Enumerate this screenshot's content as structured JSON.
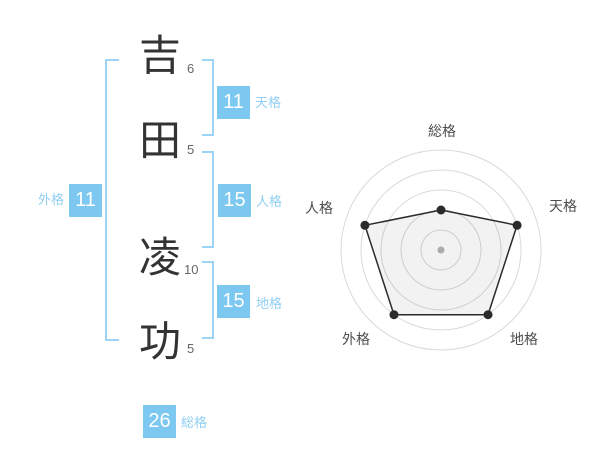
{
  "name_block": {
    "characters": [
      {
        "char": "吉",
        "strokes": "6"
      },
      {
        "char": "田",
        "strokes": "5"
      },
      {
        "char": "凌",
        "strokes": "10"
      },
      {
        "char": "功",
        "strokes": "5"
      }
    ]
  },
  "kaku": {
    "tenkaku": {
      "label": "天格",
      "value": "11"
    },
    "jinkaku": {
      "label": "人格",
      "value": "15"
    },
    "chikaku": {
      "label": "地格",
      "value": "15"
    },
    "gaikaku": {
      "label": "外格",
      "value": "11"
    },
    "soukaku": {
      "label": "総格",
      "value": "26"
    }
  },
  "colors": {
    "badge_bg": "#7cc8f0",
    "badge_text": "#ffffff",
    "kaku_label": "#90cff3",
    "bracket": "#9dd4f5",
    "name_text": "#333333",
    "stroke_count_text": "#666666",
    "radar_axis_label": "#4d4d4d",
    "radar_grid": "#d9d9d9",
    "radar_series": "#2b2b2b",
    "radar_center_dot": "#b5b5b5"
  },
  "chart_data": {
    "type": "radar",
    "axes": [
      "総格",
      "天格",
      "地格",
      "外格",
      "人格"
    ],
    "values": [
      2,
      4,
      4,
      4,
      4
    ],
    "scale_max": 5,
    "ring_count": 5,
    "angles_deg": [
      -90,
      -18,
      54,
      126,
      198
    ],
    "grid": "circular",
    "legend": "none",
    "fill_opacity": 0.05
  }
}
